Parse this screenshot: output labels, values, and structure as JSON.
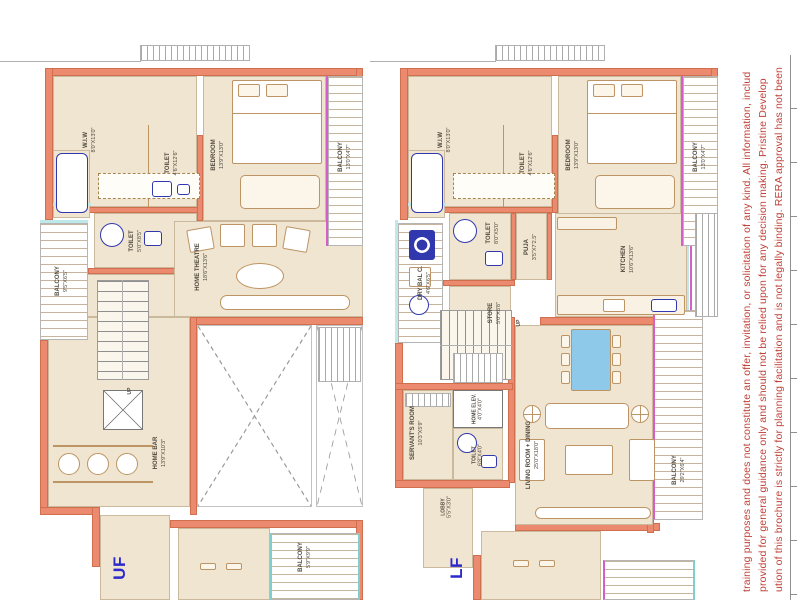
{
  "colors": {
    "wall": "#eb8a6e",
    "floor": "#f0e5d1",
    "fixture_blue": "#3138ad",
    "accent_magenta": "#d65ec8",
    "accent_teal": "#7fd0cc",
    "disclaimer_red": "#bf4238",
    "floor_label_blue": "#2b29cc"
  },
  "disclaimer": {
    "lines": [
      "training purposes and does not constitute an offer, invitation, or solicitation of any kind. All information, includ",
      "provided for general guidance only and should not be relied upon for any decision making. Pristine Develop",
      "ution of this brochure is strictly for planning facilitation and is not legally binding. RERA approval has not been"
    ]
  },
  "plan_left": {
    "floor_label": "UF",
    "rooms": {
      "wiw": {
        "name": "W.I.W",
        "dims": "8'0\"X13'0\""
      },
      "bedroom": {
        "name": "BEDROOM",
        "dims": "13'9\"X13'0\""
      },
      "balcony_top": {
        "name": "BALCONY",
        "dims": "13'0\"X4'7\""
      },
      "toilet_a": {
        "name": "TOILET",
        "dims": "4'6\"X12'6\""
      },
      "toilet_b": {
        "name": "TOILET",
        "dims": "5'0\"X8'5\""
      },
      "balcony_left": {
        "name": "BALCONY",
        "dims": "9'5\"X6'5\""
      },
      "home_theatre": {
        "name": "HOME THEATRE",
        "dims": "18'6\"X13'6\""
      },
      "home_bar": {
        "name": "HOME BAR",
        "dims": "13'9\"X10'3\""
      },
      "balcony_bottom": {
        "name": "BALCONY",
        "dims": "5'9\"X9'9\""
      },
      "stairs": {
        "name": "UP"
      }
    }
  },
  "plan_right": {
    "floor_label": "LF",
    "rooms": {
      "wiw": {
        "name": "W.I.W",
        "dims": "8'0\"X13'0\""
      },
      "bedroom": {
        "name": "BEDROOM",
        "dims": "13'9\"X13'0\""
      },
      "balcony_top": {
        "name": "BALCONY",
        "dims": "13'0\"X4'7\""
      },
      "toilet_a": {
        "name": "TOILET",
        "dims": "4'6\"X12'6\""
      },
      "toilet_b": {
        "name": "TOILET",
        "dims": "8'0\"X5'0\""
      },
      "puja": {
        "name": "PUJA",
        "dims": "3'5\"X7'2.5\""
      },
      "dry_bal": {
        "name": "DRY BAL C.",
        "dims": "4'6\"X6'5\""
      },
      "store": {
        "name": "STORE",
        "dims": "5'0\"X8'8\""
      },
      "kitchen": {
        "name": "KITCHEN",
        "dims": "10'6\"X13'6\""
      },
      "servants_room": {
        "name": "SERVANT'S ROOM",
        "dims": "10'3\"X5'9\""
      },
      "home_elev": {
        "name": "HOME ELEV.",
        "dims": "4'0\"X4'0\""
      },
      "toilet_c": {
        "name": "TOILET",
        "dims": "6'8\"X4'0\""
      },
      "lobby": {
        "name": "LOBBY",
        "dims": "5'5\"X3'0\""
      },
      "living_dining": {
        "name": "LIVING ROOM + DINING",
        "dims": "25'0\"X18'0\""
      },
      "balcony_right": {
        "name": "BALCONY",
        "dims": "29'2\"X6'4\""
      },
      "stairs": {
        "name": "UP"
      }
    }
  }
}
